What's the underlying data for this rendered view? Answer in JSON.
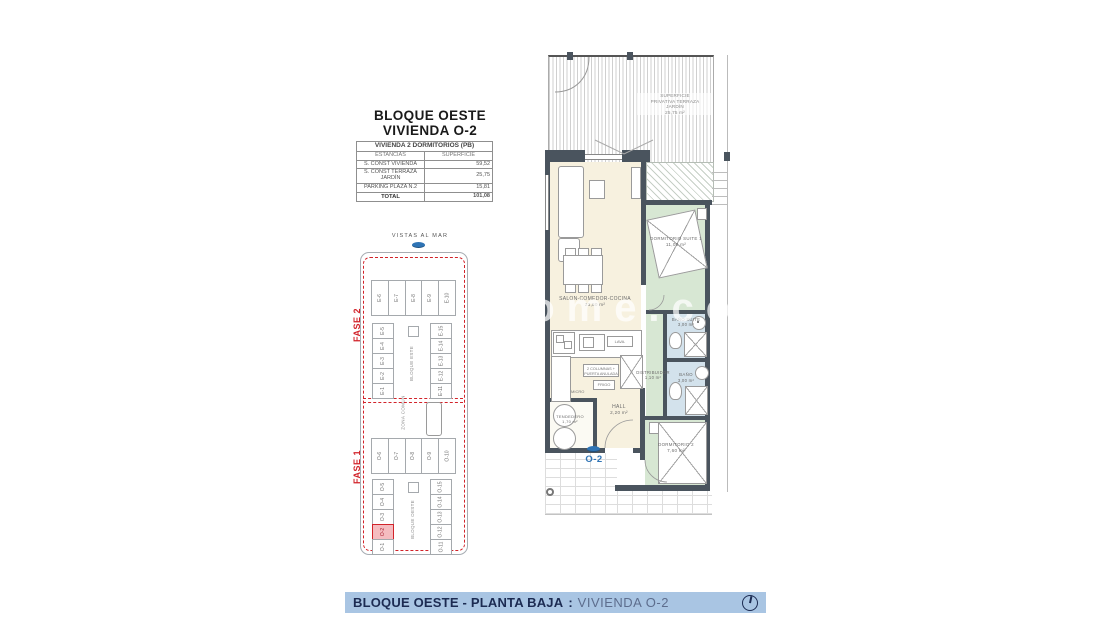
{
  "doc": {
    "title1": "BLOQUE OESTE",
    "title2": "VIVIENDA O-2"
  },
  "surface_table": {
    "header": "VIVIENDA 2 DORMITORIOS (PB)",
    "col1": "ESTANCIAS",
    "col2": "SUPERFICIE",
    "rows": [
      {
        "name": "S. CONST VIVIENDA",
        "value": "59,52"
      },
      {
        "name": "S. CONST TERRAZA JARDÍN",
        "value": "25,75"
      },
      {
        "name": "PARKING   PLAZA   N.2",
        "value": "15,81"
      }
    ],
    "total_label": "TOTAL",
    "total_value": "101,08"
  },
  "site_plan": {
    "vistas": "VISTAS AL MAR",
    "fase2": "FASE 2",
    "fase1": "FASE 1",
    "zona_comun": "ZONA COMUN",
    "bloque_este": "BLOQUE ESTE",
    "bloque_oeste": "BLOQUE OESTE",
    "este_top": [
      "E-6",
      "E-7",
      "E-8",
      "E-9",
      "E-10"
    ],
    "este_left": [
      "E-5",
      "E-4",
      "E-3",
      "E-2",
      "E-1"
    ],
    "este_right": [
      "E-15",
      "E-14",
      "E-13",
      "E-12",
      "E-11"
    ],
    "oeste_top": [
      "O-6",
      "O-7",
      "O-8",
      "O-9",
      "O-10"
    ],
    "oeste_left": [
      "O-5",
      "O-4",
      "O-3",
      "O-2",
      "O-1"
    ],
    "oeste_right": [
      "O-15",
      "O-14",
      "O-13",
      "O-12",
      "O-11"
    ],
    "highlighted_unit": "O-2"
  },
  "plan": {
    "terrace": {
      "l1": "SUPERFICIE",
      "l2": "PRIVATIVA TERRAZA",
      "l3": "JARDÍN",
      "l4": "25,75 m²"
    },
    "rooms": {
      "salon": {
        "name": "SALON-COMEDOR-COCINA",
        "area": "23,50 m²"
      },
      "suite": {
        "name": "DORMITORIO SUITE 1",
        "area": "11,00 m²"
      },
      "bano_suite": {
        "name": "BAÑO SUITE",
        "area": "3,00 m²"
      },
      "bano": {
        "name": "BAÑO",
        "area": "3,00 m²"
      },
      "distribuidor": {
        "name": "DISTRIBUIDOR",
        "area": "1,10 m²"
      },
      "hall": {
        "name": "HALL",
        "area": "2,20 m²"
      },
      "dorm2": {
        "name": "DORMITORIO 2",
        "area": "7,60 m²"
      },
      "tendedero": {
        "name": "TENDEDERO",
        "area": "1,70 m²"
      }
    },
    "kitchen": {
      "lava": "LAVA.",
      "columnas": "2 COLUMNAS + PUERTA ANULADA",
      "frigo": "FRIGO",
      "micro": "MICRO"
    },
    "unit": "O-2"
  },
  "watermark": "ome.com",
  "footer": {
    "bold": "BLOQUE OESTE - PLANTA BAJA",
    "sep": ":",
    "regular": "VIVIENDA O-2"
  },
  "colors": {
    "accent_blue": "#2F74B5",
    "fase_red": "#D2232A",
    "banner_bg": "#A9C5E3",
    "banner_text": "#1C2B52",
    "wall": "#4A545E",
    "cream": "#F7F1DF",
    "green": "#D7E7D3",
    "blue_room": "#D3E2EC",
    "highlight": "#F5BCC0"
  }
}
